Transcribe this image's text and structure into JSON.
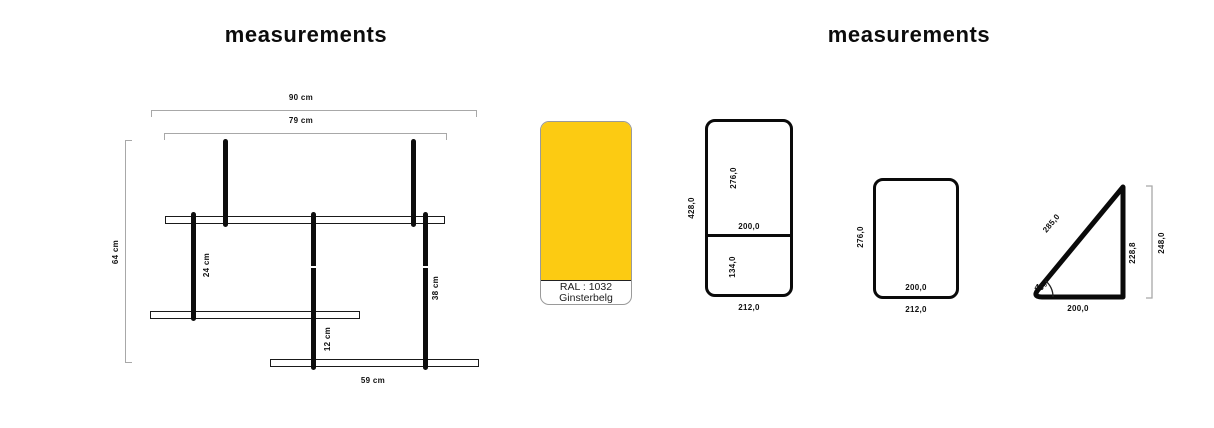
{
  "left_section": {
    "title": "measurements",
    "shelf_drawing": {
      "outer_width": "90 cm",
      "inner_width": "79 cm",
      "total_height": "64 cm",
      "left_rod": "24 cm",
      "middle_rod": "12 cm",
      "right_rod": "38 cm",
      "bottom_shelf_width": "59 cm"
    },
    "color_swatch": {
      "code": "RAL : 1032",
      "name": "Ginsterbelg",
      "hex": "#FCCB12"
    }
  },
  "right_section": {
    "title": "measurements",
    "divided_panel": {
      "overall_height": "428,0",
      "upper_height": "276,0",
      "inner_width": "200,0",
      "lower_height": "134,0",
      "base_width": "212,0"
    },
    "plain_panel": {
      "height": "276,0",
      "inner_width": "200,0",
      "base_width": "212,0"
    },
    "triangle_panel": {
      "hypotenuse": "285,0",
      "angle": "45°",
      "base": "200,0",
      "side_height": "228,8",
      "overall_height": "248,0"
    }
  },
  "colors": {
    "ink": "#111111",
    "dimension_line": "#a8a8a8",
    "swatch_yellow": "#FCCB12"
  }
}
